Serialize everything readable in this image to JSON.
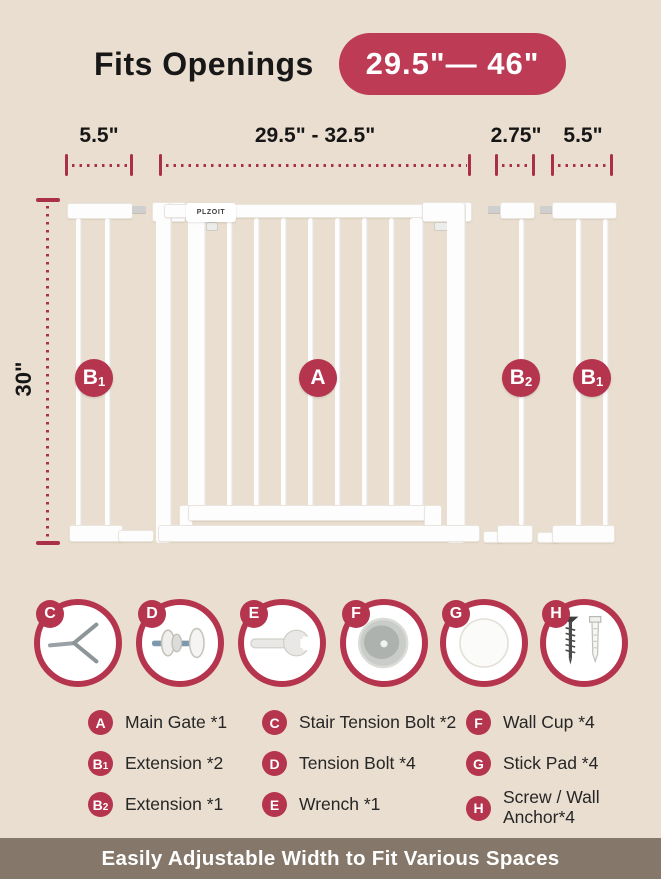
{
  "header": {
    "title": "Fits Openings",
    "range_pill": "29.5\"— 46\""
  },
  "dimensions": {
    "top": [
      {
        "label": "5.5\"",
        "part": "left-extension-b1"
      },
      {
        "label": "29.5\" - 32.5\"",
        "part": "main-gate-a"
      },
      {
        "label": "2.75\"",
        "part": "extension-b2"
      },
      {
        "label": "5.5\"",
        "part": "right-extension-b1"
      }
    ],
    "height": "30\""
  },
  "gate": {
    "brand": "PLZOIT",
    "labels": [
      {
        "badge": "B",
        "sub": "1"
      },
      {
        "badge": "A",
        "sub": ""
      },
      {
        "badge": "B",
        "sub": "2"
      },
      {
        "badge": "B",
        "sub": "1"
      }
    ]
  },
  "parts": {
    "circles": [
      {
        "letter": "C",
        "icon": "stair-tension-bolt-icon"
      },
      {
        "letter": "D",
        "icon": "tension-bolt-icon"
      },
      {
        "letter": "E",
        "icon": "wrench-icon"
      },
      {
        "letter": "F",
        "icon": "wall-cup-icon"
      },
      {
        "letter": "G",
        "icon": "stick-pad-icon"
      },
      {
        "letter": "H",
        "icon": "screw-wall-anchor-icon"
      }
    ],
    "legend": [
      {
        "badge": "A",
        "sub": "",
        "label": "Main Gate *1"
      },
      {
        "badge": "B",
        "sub": "1",
        "label": "Extension *2"
      },
      {
        "badge": "B",
        "sub": "2",
        "label": "Extension *1"
      },
      {
        "badge": "C",
        "sub": "",
        "label": "Stair Tension Bolt *2"
      },
      {
        "badge": "D",
        "sub": "",
        "label": "Tension Bolt *4"
      },
      {
        "badge": "E",
        "sub": "",
        "label": "Wrench *1"
      },
      {
        "badge": "F",
        "sub": "",
        "label": "Wall Cup *4"
      },
      {
        "badge": "G",
        "sub": "",
        "label": "Stick Pad *4"
      },
      {
        "badge": "H",
        "sub": "",
        "label": "Screw / Wall Anchor*4"
      }
    ]
  },
  "footer": {
    "banner": "Easily Adjustable Width to Fit Various Spaces"
  },
  "colors": {
    "background": "#e9decf",
    "accent_crimson": "#b5344e",
    "pill_red": "#bd3b54",
    "dimension_red": "#a93048",
    "banner_taupe": "#85786a",
    "gate_white": "#fdfdfd"
  }
}
